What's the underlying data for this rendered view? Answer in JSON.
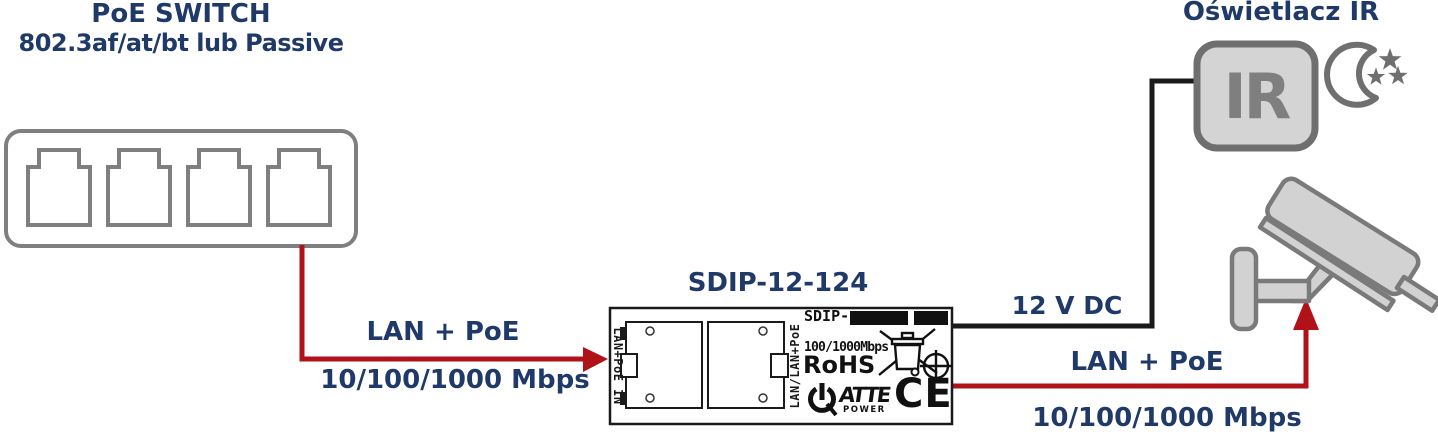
{
  "colors": {
    "label_navy": "#1f3968",
    "cable_red": "#b01218",
    "cable_black": "#1a1a1a",
    "device_gray_stroke": "#7a7a7a",
    "device_gray_fill": "#d3d3d3",
    "print_black": "#111111"
  },
  "poe_switch": {
    "title_line1": "PoE SWITCH",
    "title_line2": "802.3af/at/bt lub Passive",
    "ports": 4
  },
  "converter": {
    "title": "SDIP-12-124",
    "left_port_label": "LAN+PoE IN",
    "right_port_label": "LAN/LAN+PoE",
    "model_prefix": "SDIP-",
    "speed_print": "100/1000Mbps",
    "rohs_print": "RoHS",
    "brand_print": "ATTE",
    "brand_sub_print": "POWER",
    "ce_print": "CE"
  },
  "ir_illuminator": {
    "title": "Oświetlacz IR",
    "icon_text": "IR"
  },
  "links": {
    "switch_to_converter": {
      "label_top": "LAN + PoE",
      "label_bottom": "10/100/1000 Mbps"
    },
    "converter_to_ir": {
      "label": "12 V DC"
    },
    "converter_to_camera": {
      "label_top": "LAN + PoE",
      "label_bottom": "10/100/1000 Mbps"
    }
  },
  "icons": {
    "switch": "rj45-switch-icon",
    "converter_jacks": "rj45-jack-icon",
    "weee": "crossed-out-bin-icon",
    "calibration": "crosshair-circle-icon",
    "power": "power-symbol-icon",
    "ir_box": "ir-illuminator-icon",
    "night": "moon-and-stars-icon",
    "camera": "cctv-camera-icon",
    "arrows": "red-arrow-icon"
  }
}
